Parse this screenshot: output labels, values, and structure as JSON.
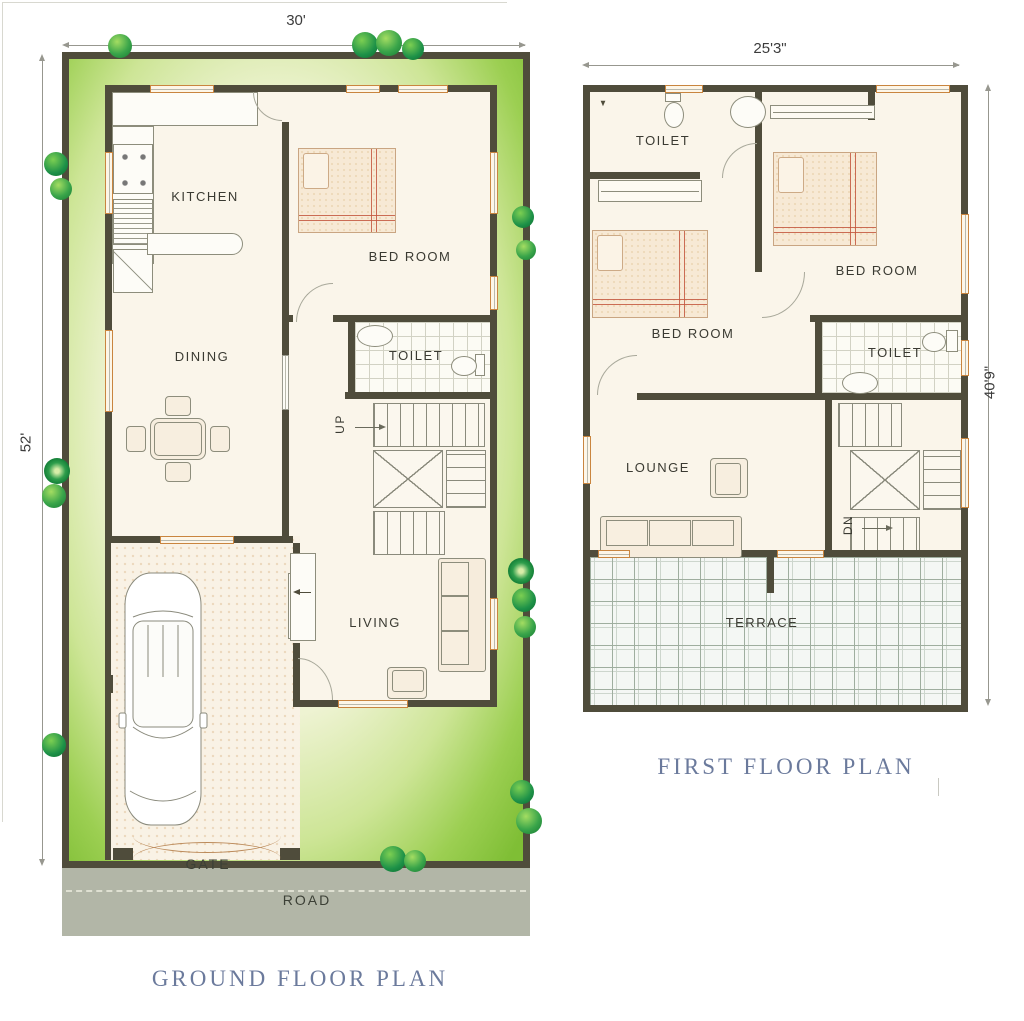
{
  "ground_floor": {
    "title": "GROUND FLOOR PLAN",
    "width_dim": "30'",
    "height_dim": "52'",
    "labels": {
      "kitchen": "KITCHEN",
      "bedroom": "BED ROOM",
      "dining": "DINING",
      "toilet": "TOILET",
      "living": "LIVING",
      "stairs_up": "UP",
      "gate": "GATE",
      "road": "ROAD"
    }
  },
  "first_floor": {
    "title": "FIRST FLOOR PLAN",
    "width_dim": "25'3\"",
    "height_dim": "40'9\"",
    "labels": {
      "toilet_top": "TOILET",
      "bedroom_left": "BED ROOM",
      "bedroom_right": "BED ROOM",
      "toilet_mid": "TOILET",
      "lounge": "LOUNGE",
      "terrace": "TERRACE",
      "stairs_dn": "DN"
    }
  },
  "colors": {
    "wall": "#4f4c3b",
    "lawn_edge": "#85c23c",
    "lawn_center": "#eef3d2",
    "floor": "#faf5ea",
    "road": "#b2b6a7",
    "window_frame": "#c9853f",
    "bed_accent": "#c4573e",
    "title_text": "#6b7a9c",
    "tree_green": "#2f9e4c"
  }
}
